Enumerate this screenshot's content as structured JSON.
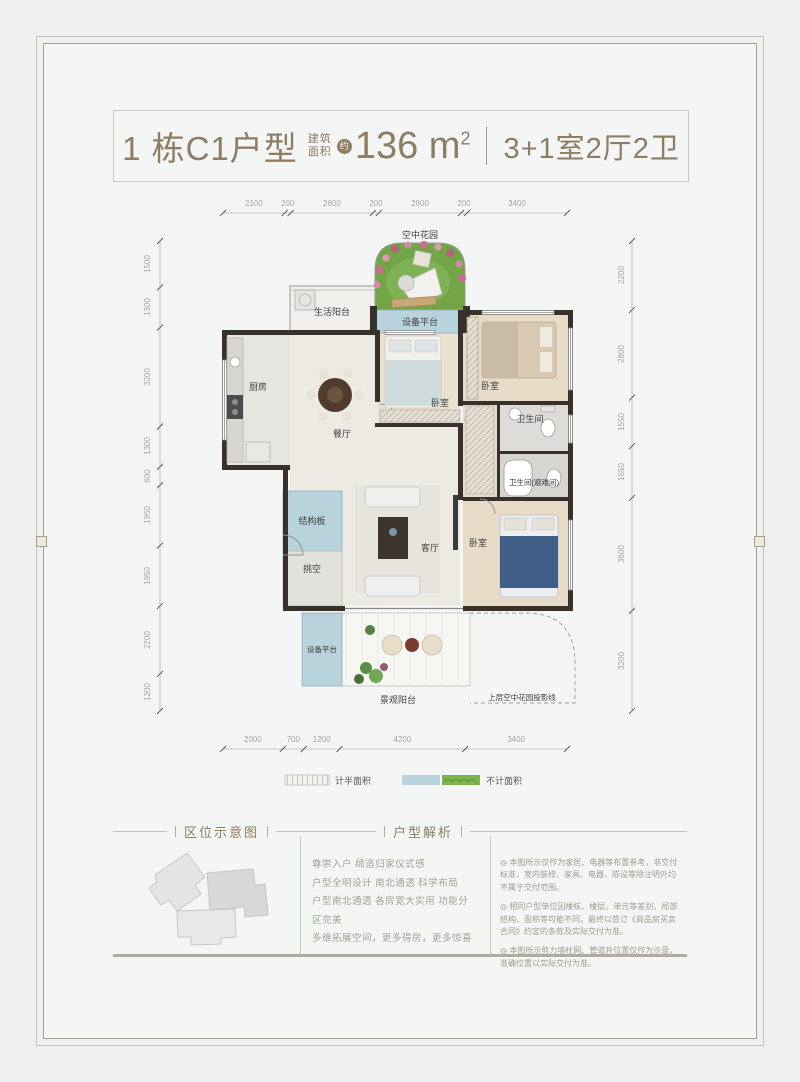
{
  "title": {
    "block_unit": "1 栋C1户型",
    "area_label_l1": "建筑",
    "area_label_l2": "面积",
    "approx": "约",
    "area_value": "136 m",
    "area_sup": "2",
    "rooms": "3+1室2厅2卫"
  },
  "plan": {
    "dims": {
      "top": [
        "2100",
        "200",
        "2800",
        "200",
        "2800",
        "200",
        "3400"
      ],
      "bottom": [
        "2000",
        "700",
        "1200",
        "4200",
        "3400"
      ],
      "left": [
        "1500",
        "1300",
        "3200",
        "1300",
        "600",
        "1950",
        "1950",
        "2200",
        "1200"
      ],
      "right": [
        "2200",
        "2800",
        "1550",
        "1650",
        "3600",
        "3200"
      ]
    },
    "rooms": {
      "sky_garden": "空中花园",
      "equip_top": "设备平台",
      "life_balcony": "生活阳台",
      "kitchen": "厨房",
      "dining": "餐厅",
      "bedroom_mid": "卧室",
      "bedroom_top_right": "卧室",
      "bath1": "卫生间",
      "bath2": "卫生间(避难间)",
      "living": "客厅",
      "bedroom_bottom": "卧室",
      "structure_board": "结构板",
      "void_space": "挑空",
      "equip_bottom": "设备平台",
      "view_balcony": "景观阳台",
      "projection": "上层空中花园投影线"
    },
    "legend": {
      "half_area": "计半面积",
      "excluded_area": "不计面积"
    }
  },
  "sections": {
    "location_title": "区位示意图",
    "analysis_title": "户型解析",
    "analysis_lines": [
      "尊崇入户 缔造归家仪式感",
      "户型全明设计 南北通透 科学布局",
      "户型南北通透 各房宽大实用 功能分区完美",
      "多维拓展空间，更多得房，更多惊喜"
    ]
  },
  "notes": [
    "◎ 本图所示仅作为家居、电器等布置参考，非交付标准，室内装修、家具、电器、陈设等除注明外均不属于交付范围。",
    "◎ 相同户型单位因楼栋、楼层、单元等差别，局部结构、面积等可能不同，最终以签订《商品房买卖合同》约定的条款及实际交付为准。",
    "◎ 本图所示剪力墙柱网、管道井位置仅作为示意，准确位置以实际交付为准。"
  ],
  "colors": {
    "accent_brown": "#8d7d63",
    "wall_dark": "#38302a",
    "half_blue": "#b9d3dd",
    "garden_green": "#71a546",
    "legend_green": "#7fb24a",
    "page_bg": "#f4f6f5"
  }
}
